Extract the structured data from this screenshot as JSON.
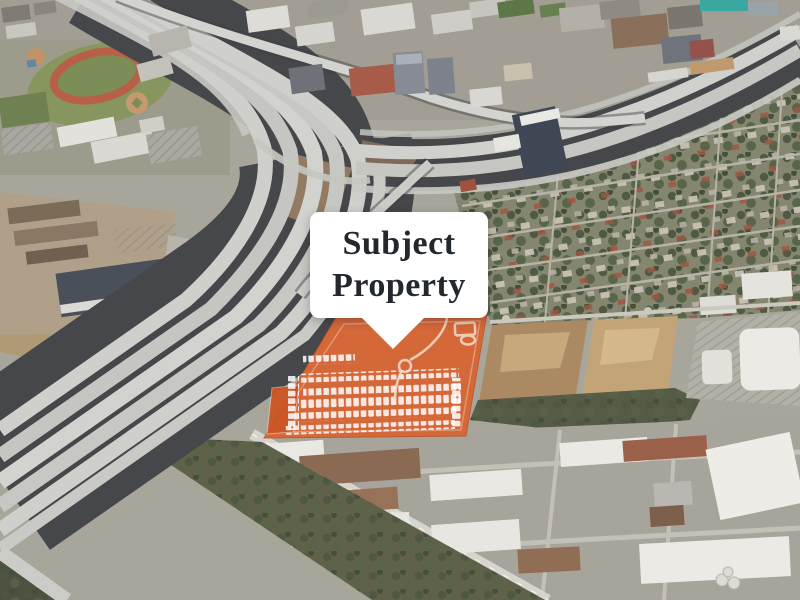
{
  "callout": {
    "line1": "Subject",
    "line2": "Property",
    "full_label": "Subject Property",
    "background_color": "#ffffff",
    "text_color": "#23272e"
  },
  "map": {
    "type": "aerial-3d-satellite",
    "highlight": {
      "name": "subject-property-parcel",
      "color": "#d85e2e"
    },
    "features": [
      "freeway-interchange",
      "elevated-highway",
      "school-campus-athletic-track",
      "urban-commercial-district",
      "residential-neighborhood",
      "cleared-dirt-lots",
      "industrial-warehouse-park",
      "big-box-retail-site",
      "subject-property-parcel"
    ]
  }
}
